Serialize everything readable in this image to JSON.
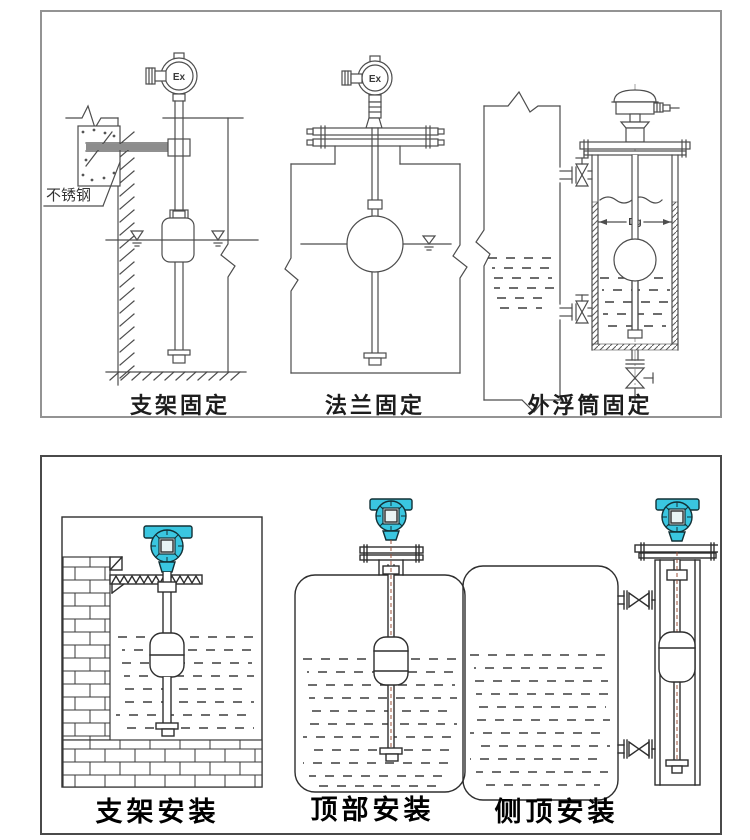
{
  "colors": {
    "line": "#4d4d4d",
    "panel_border_top": "#939393",
    "panel_border_bottom": "#4a4a4a",
    "transmitter_cyan": "#3ac6e0",
    "stem_centerline_red": "#9c5038"
  },
  "panels": {
    "top": {
      "figures": [
        {
          "id": "bracket-fixing",
          "caption": "支架固定",
          "head_label": "Ex",
          "annotation": "不锈钢"
        },
        {
          "id": "flange-fixing",
          "caption": "法兰固定",
          "head_label": "Ex"
        },
        {
          "id": "external-chamber-fixing",
          "caption": "外浮筒固定",
          "dimension_label": "Dg"
        }
      ]
    },
    "bottom": {
      "figures": [
        {
          "id": "bracket-mounting",
          "caption": "支架安装"
        },
        {
          "id": "top-mounting",
          "caption": "顶部安装"
        },
        {
          "id": "side-top-mounting",
          "caption": "侧顶安装"
        }
      ]
    }
  }
}
